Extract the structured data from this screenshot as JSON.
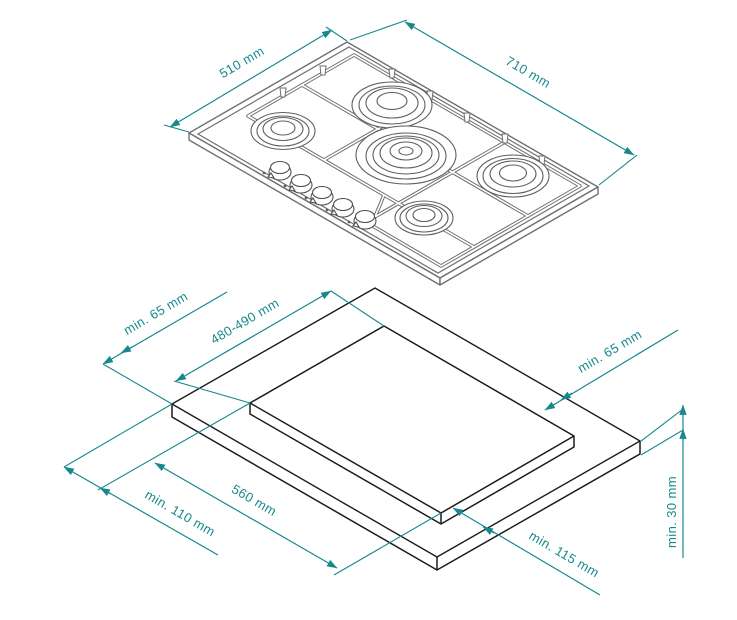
{
  "diagram": {
    "type": "gas-hob-installation-drawing",
    "colors": {
      "dimension_teal": "#17898d",
      "worktop_line": "#1c1c1c",
      "hob_line": "#707070"
    },
    "hob_view": {
      "depth": "510 mm",
      "width": "710 mm",
      "burner_count": 5,
      "knob_count": 5
    },
    "worktop_view": {
      "clearance_back_left": "min. 65 mm",
      "cutout_depth": "480-490 mm",
      "clearance_back_right": "min. 65 mm",
      "cutout_width": "560 mm",
      "clearance_front_left": "min. 110 mm",
      "clearance_front_right": "min. 115 mm",
      "worktop_thickness": "min. 30 mm"
    }
  }
}
